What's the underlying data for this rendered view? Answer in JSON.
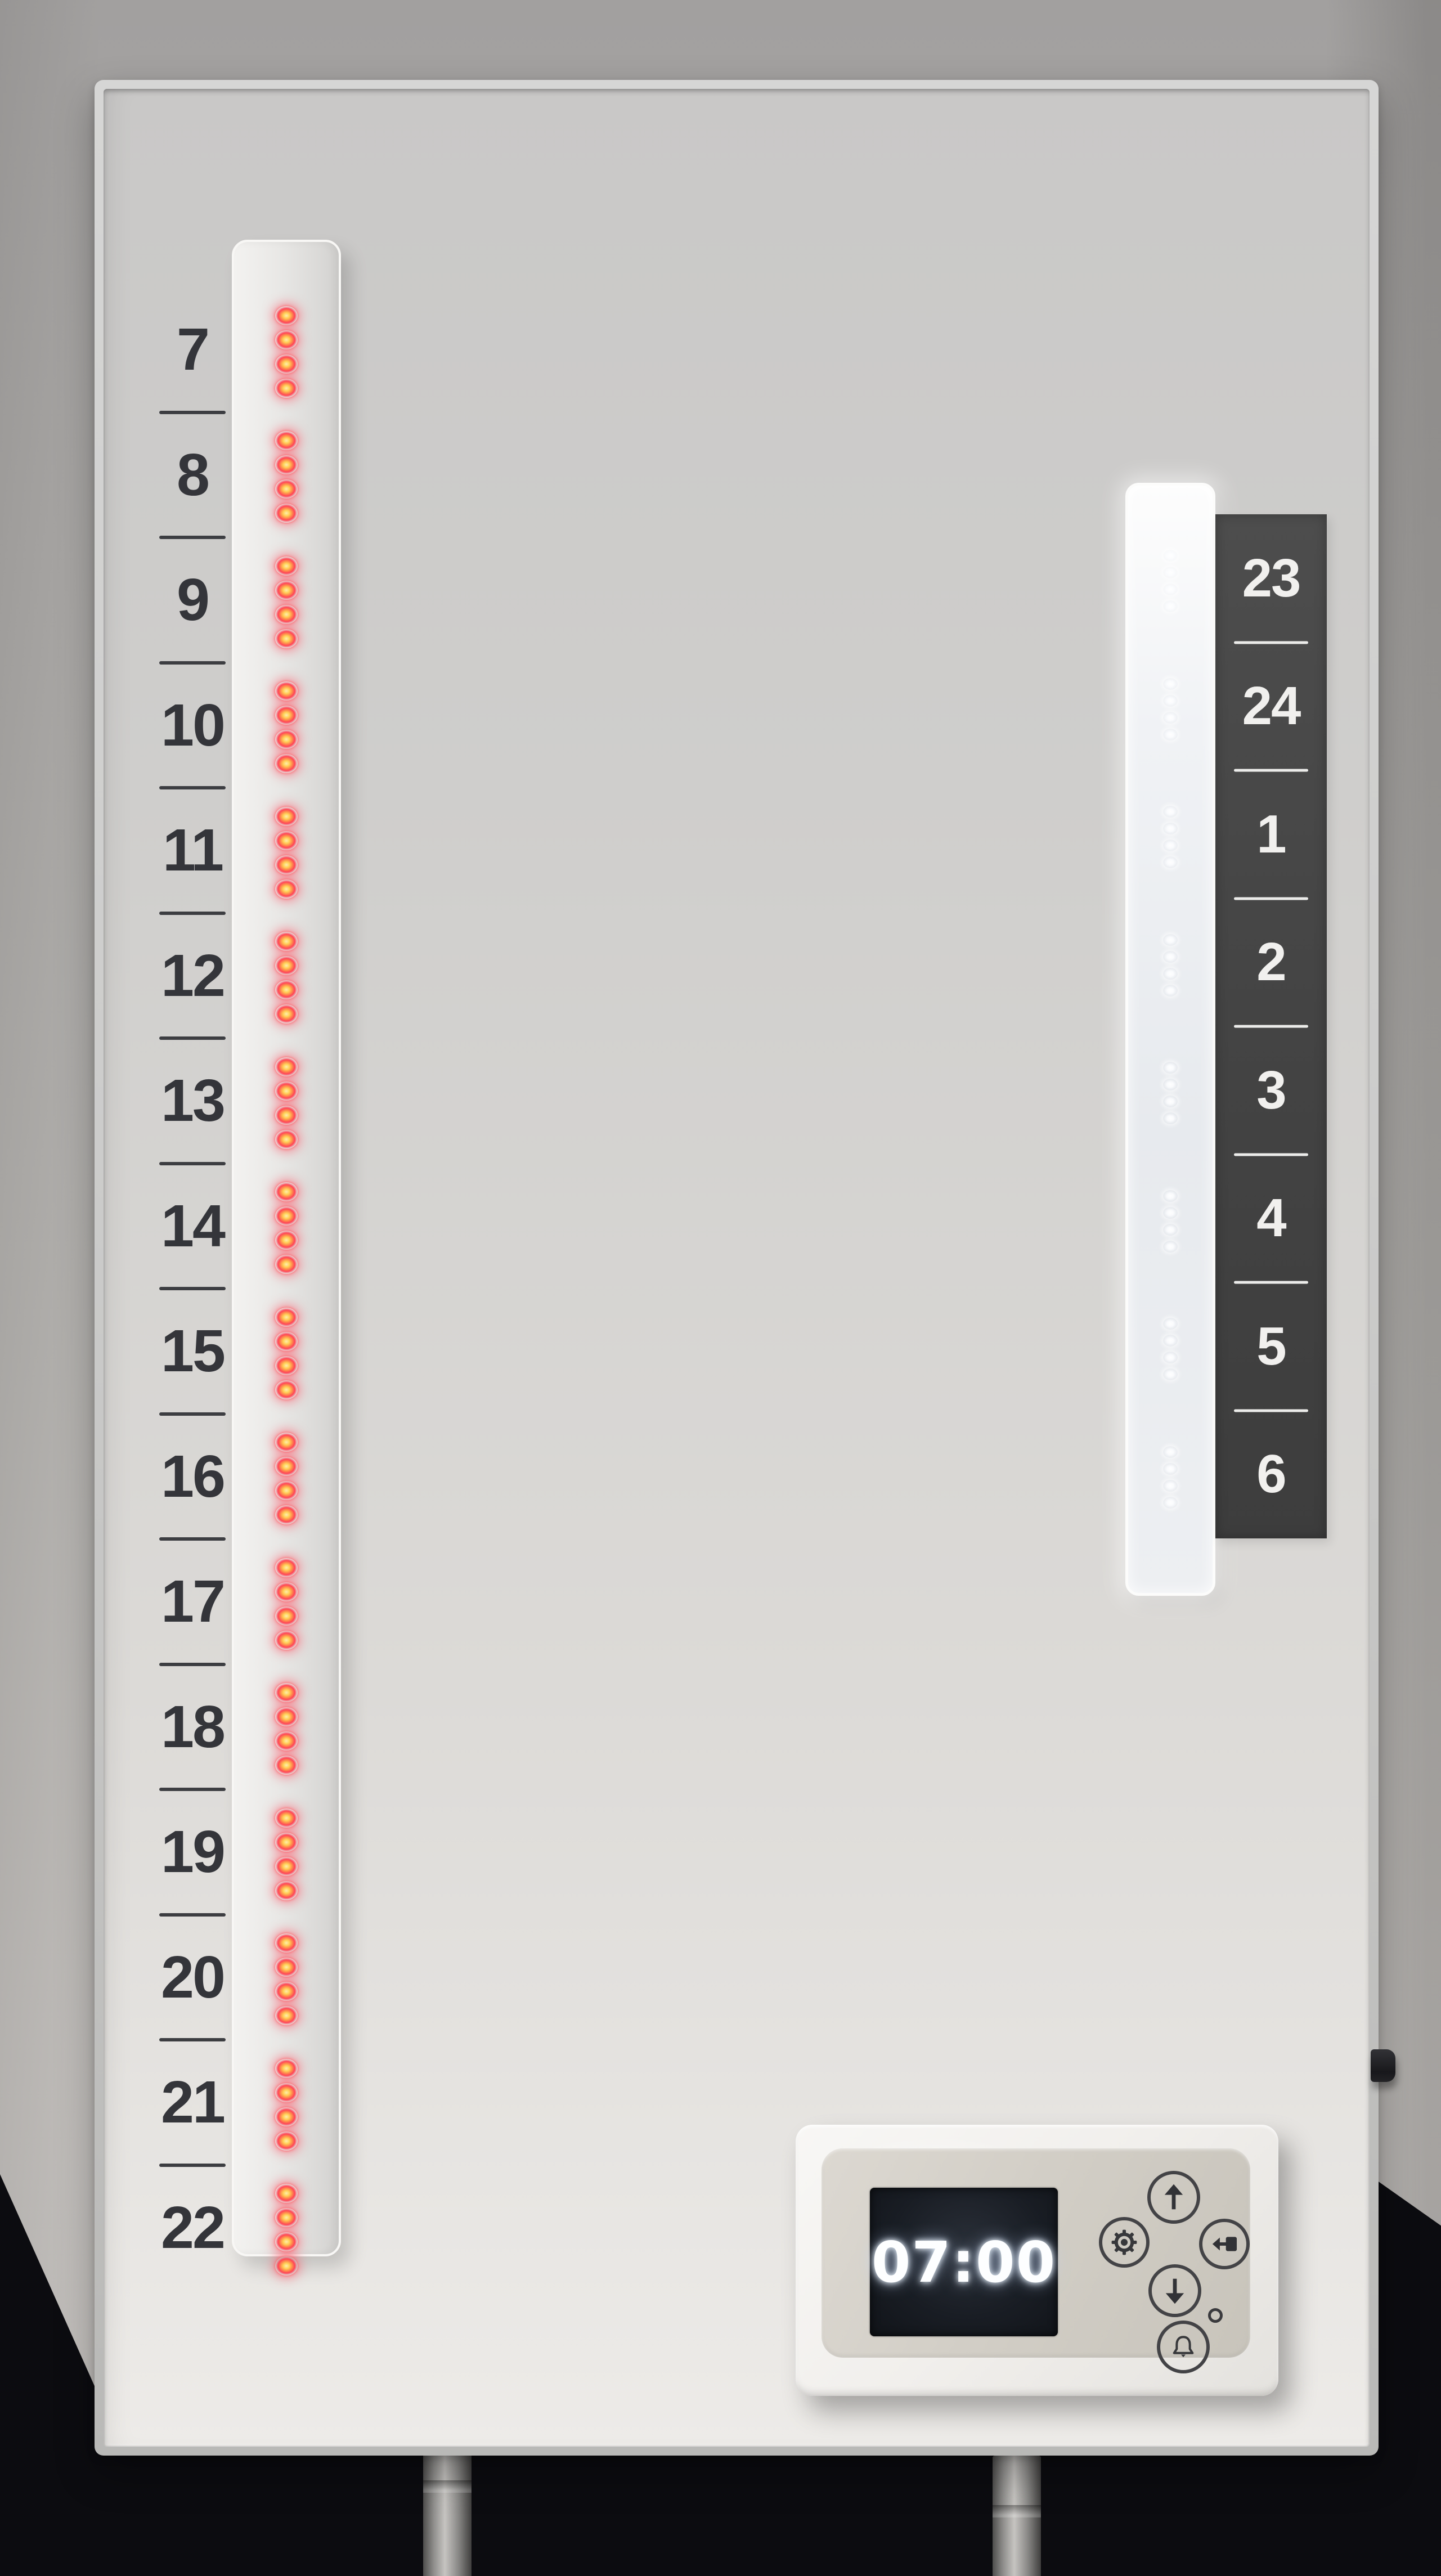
{
  "day_scale": {
    "hours": [
      "7",
      "8",
      "9",
      "10",
      "11",
      "12",
      "13",
      "14",
      "15",
      "16",
      "17",
      "18",
      "19",
      "20",
      "21",
      "22"
    ]
  },
  "night_scale": {
    "hours": [
      "23",
      "24",
      "1",
      "2",
      "3",
      "4",
      "5",
      "6"
    ]
  },
  "led_display": {
    "day": {
      "groups": 16,
      "leds_per_group": 4,
      "state": "lit",
      "color": "#ff4456"
    },
    "night": {
      "groups": 8,
      "leds_per_group": 4,
      "state": "unlit",
      "color": "#ffffff"
    }
  },
  "control_panel": {
    "display_time": "07:00",
    "buttons": [
      {
        "name": "up",
        "icon": "arrow-up-icon"
      },
      {
        "name": "settings",
        "icon": "gear-icon"
      },
      {
        "name": "down",
        "icon": "arrow-down-icon"
      },
      {
        "name": "confirm",
        "icon": "enter-arrow-icon"
      },
      {
        "name": "alarm",
        "icon": "bell-icon"
      }
    ]
  },
  "colors": {
    "led_red": "#ff4456",
    "night_label_background": "#434343",
    "night_label_text": "#f1f0ee",
    "day_label_text": "#34353a",
    "lcd_background": "#14171c",
    "lcd_text": "#fdfeff"
  }
}
